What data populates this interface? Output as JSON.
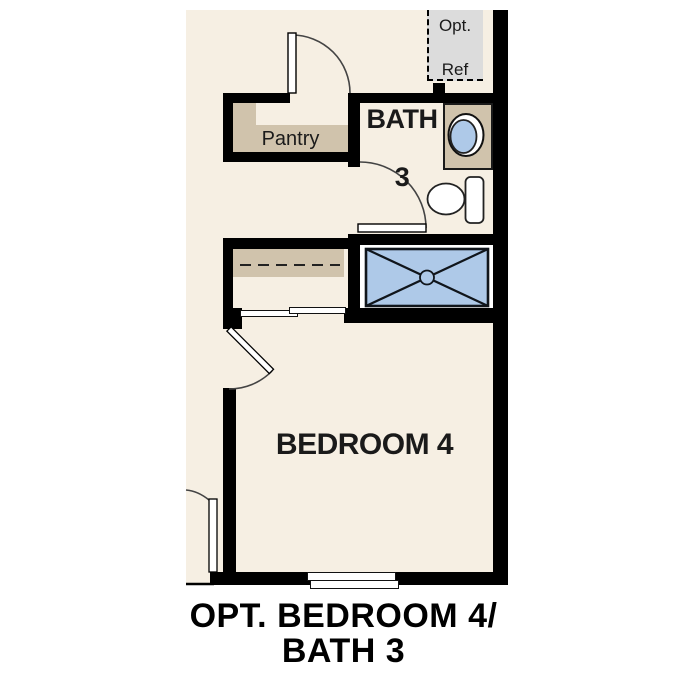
{
  "caption": {
    "line1": "OPT. BEDROOM 4/",
    "line2": "BATH 3"
  },
  "labels": {
    "bedroom": "BEDROOM 4",
    "bath_line1": "BATH",
    "bath_line2": "3",
    "pantry": "Pantry",
    "opt_ref_line1": "Opt.",
    "opt_ref_line2": "Ref"
  },
  "colors": {
    "page": "#ffffff",
    "floor": "#f6efe3",
    "tan": "#d0c3ac",
    "gray": "#dcdcdc",
    "blue": "#aec9e8",
    "wall": "#000000",
    "ink": "#1a1a1a"
  }
}
